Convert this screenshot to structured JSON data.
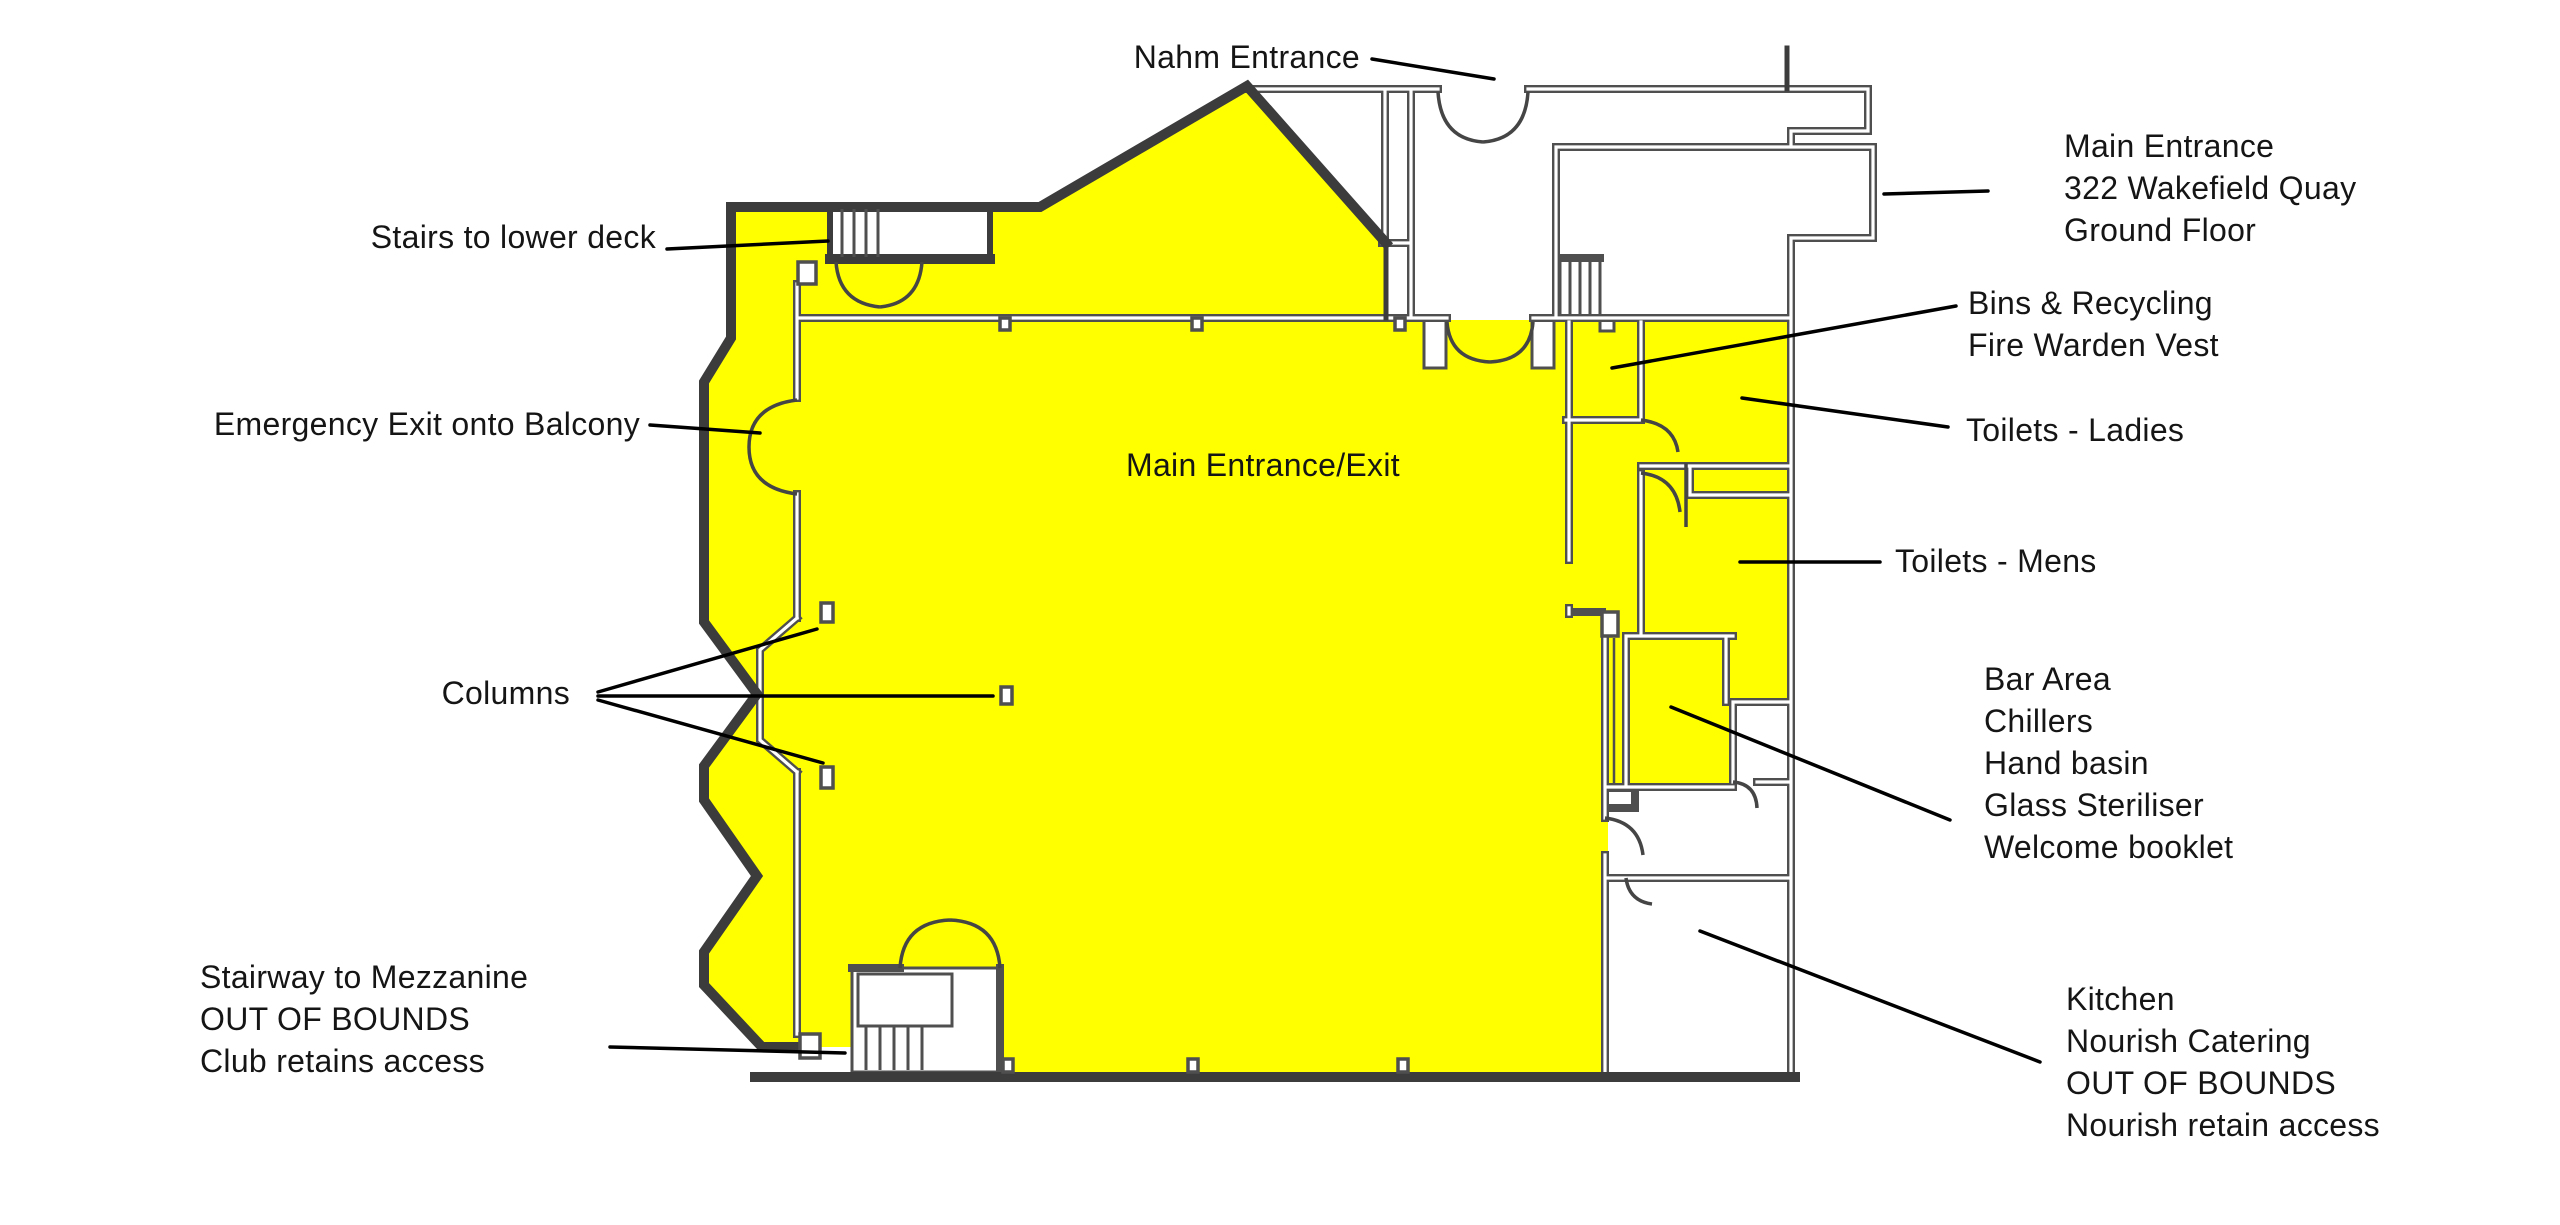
{
  "title": "Venue floor plan - 322 Wakefield Quay ground floor",
  "colors": {
    "in_bounds_highlight": "#FFFF00",
    "outer_wall": "#3C3C3C",
    "inner_wall": "#4F4F4F",
    "leader_line": "#000000",
    "label_text": "#151515",
    "background": "#FFFFFF"
  },
  "labels": {
    "nahm_entrance": {
      "text": "Nahm Entrance"
    },
    "stairs_lower_deck": {
      "text": "Stairs to lower deck"
    },
    "main_entrance_address": {
      "lines": [
        "Main Entrance",
        "322 Wakefield Quay",
        "Ground Floor"
      ]
    },
    "bins_recycling": {
      "lines": [
        "Bins & Recycling",
        "Fire Warden Vest"
      ]
    },
    "toilets_ladies": {
      "text": "Toilets - Ladies"
    },
    "toilets_mens": {
      "text": "Toilets - Mens"
    },
    "main_entrance_exit": {
      "text": "Main Entrance/Exit"
    },
    "emergency_exit": {
      "text": "Emergency Exit onto Balcony"
    },
    "columns": {
      "text": "Columns"
    },
    "stairway_mezzanine": {
      "lines": [
        "Stairway to Mezzanine",
        "OUT OF BOUNDS",
        "Club retains access"
      ]
    },
    "bar_area": {
      "lines": [
        "Bar Area",
        "Chillers",
        "Hand basin",
        "Glass Steriliser",
        "Welcome booklet"
      ]
    },
    "kitchen": {
      "lines": [
        "Kitchen",
        "Nourish Catering",
        "OUT OF BOUNDS",
        "Nourish retain access"
      ]
    }
  }
}
